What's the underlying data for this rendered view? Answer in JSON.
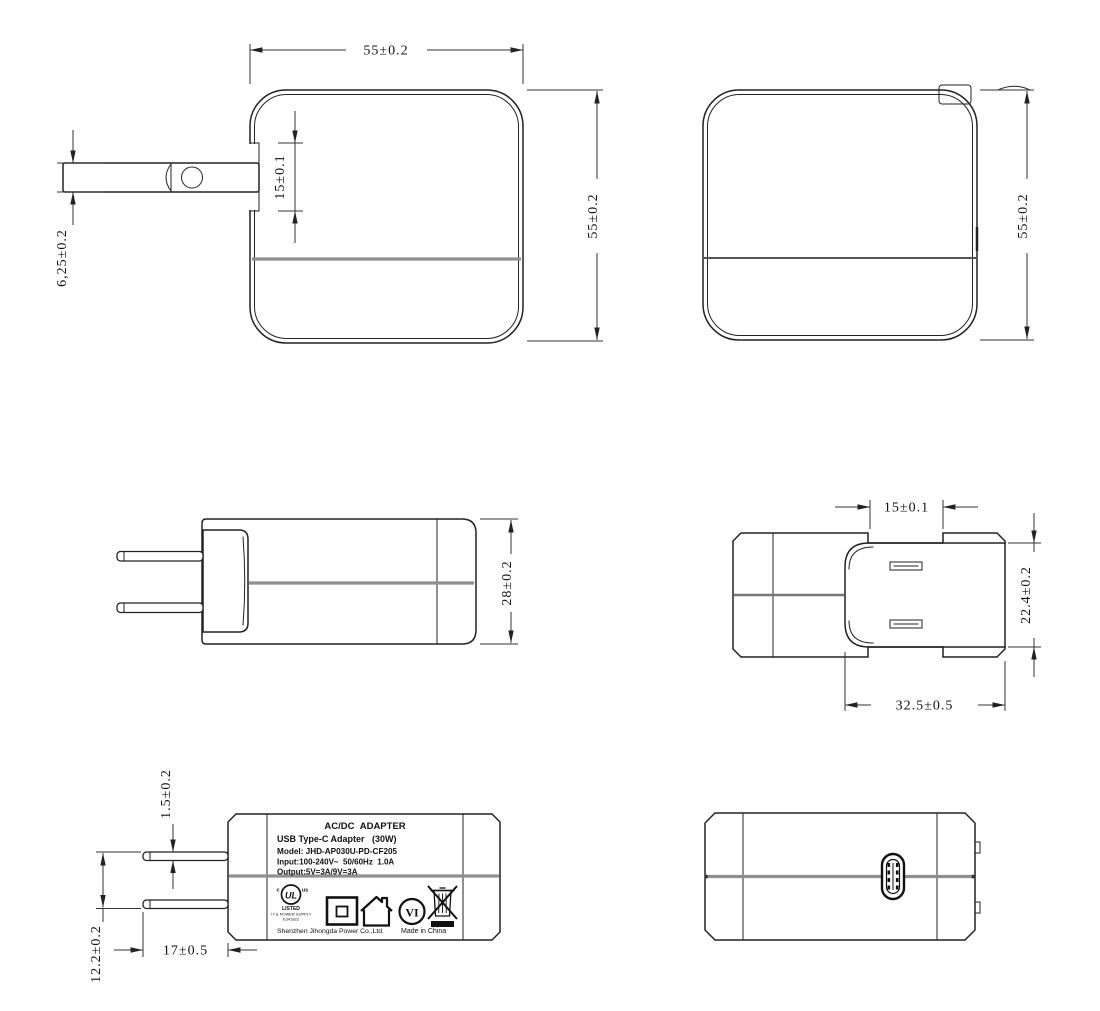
{
  "page": {
    "background": "#ffffff",
    "line_color": "#222222",
    "seam_grey": "#8f8f8f"
  },
  "views": {
    "front": {
      "width_dim": "55±0.2",
      "height_dim": "55±0.2",
      "slot_dim": "15±0.1",
      "pin_dim": "6,25±0.2"
    },
    "back": {
      "height_dim": "55±0.2"
    },
    "side": {
      "depth_dim": "28±0.2"
    },
    "top": {
      "pin_spacing_dim": "15±0.1",
      "base_height_dim": "22.4±0.2",
      "base_width_dim": "32.5±0.5"
    },
    "label_view": {
      "pin_thickness_dim": "1.5±0.2",
      "pin_gap_dim": "12.2±0.2",
      "pin_length_dim": "17±0.5"
    }
  },
  "label": {
    "title": "AC/DC  ADAPTER",
    "subtitle": "USB Type-C Adapter   (30W)",
    "model": "Model: JHD-AP030U-PD-CF205",
    "input": "Input:100-240V~  50/60Hz  1.0A",
    "output": "Output:5V=3A/9V=3A",
    "manufacturer": "Shenzhen Jihongda Power Co.,Ltd.",
    "origin": "Made in China",
    "ul_mark": {
      "left": "c",
      "center": "UL",
      "right": "us",
      "line1": "LISTED",
      "line2": "I.T.& POWER SUPPLY",
      "line3": "E341822"
    },
    "efficiency_mark": "VI"
  }
}
